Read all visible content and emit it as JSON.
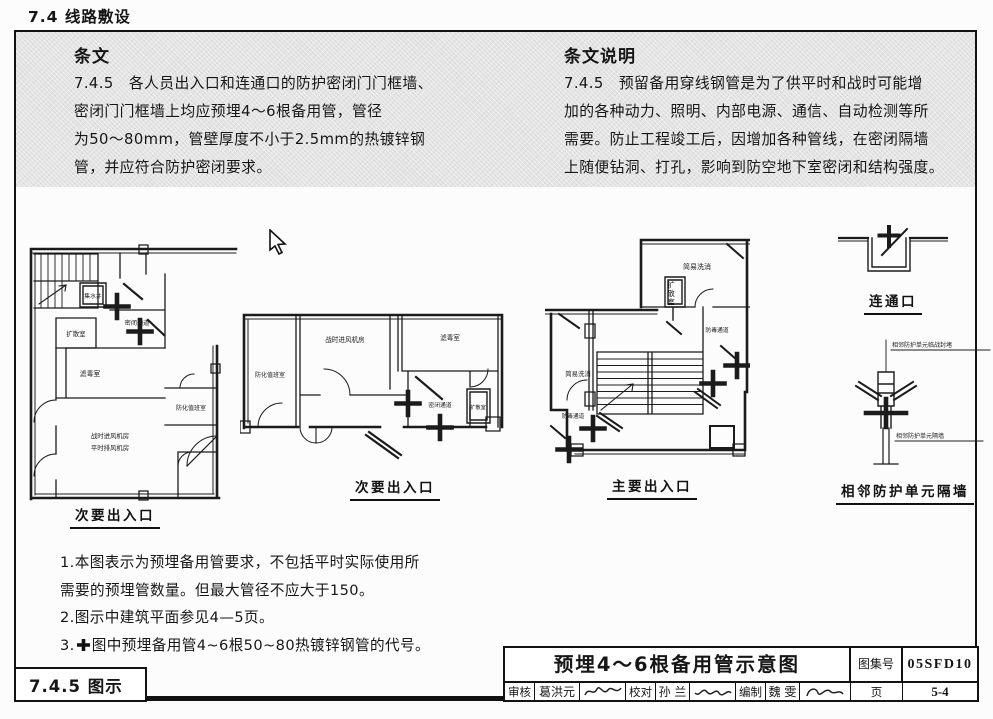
{
  "page": {
    "section_header": "7.4 线路敷设",
    "figure_label": "7.4.5 图示"
  },
  "clause": {
    "heading": "条文",
    "lines": [
      "7.4.5　各人员出入口和连通口的防护密闭门门框墙、",
      "密闭门门框墙上均应预埋4～6根备用管，管径",
      "为50～80mm，管壁厚度不小于2.5mm的热镀锌钢",
      "管，并应符合防护密闭要求。"
    ]
  },
  "explanation": {
    "heading": "条文说明",
    "lines": [
      "7.4.5　预留备用穿线钢管是为了供平时和战时可能增",
      "加的各种动力、照明、内部电源、通信、自动检测等所",
      "需要。防止工程竣工后，因增加各种管线，在密闭隔墙",
      "上随便钻洞、打孔，影响到防空地下室密闭和结构强度。"
    ]
  },
  "plans": {
    "plan1": {
      "caption": "次要出入口",
      "rooms": {
        "sump": "集水井",
        "diffusion": "扩散室",
        "sealed_passage": "密闭通道",
        "filter": "滤毒室",
        "duty": "防化值班室",
        "fan_line1": "战时进风机房",
        "fan_line2": "平时排风机房"
      }
    },
    "plan2": {
      "caption": "次要出入口",
      "rooms": {
        "duty": "防化值班室",
        "fan": "战时进风机房",
        "filter": "滤毒室",
        "sealed_passage": "密闭通道",
        "diffusion": "扩散室"
      }
    },
    "plan3": {
      "caption": "主要出入口",
      "rooms": {
        "wash_right": "简易洗消",
        "diffusion": "扩散室",
        "gas_passage_right": "防毒通道",
        "wash_left": "简易洗消",
        "gas_passage_left": "防毒通道"
      }
    },
    "detail_top": {
      "caption": "连通口"
    },
    "detail_bottom": {
      "caption": "相邻防护单元隔墙",
      "label_blocking": "相邻防护单元临战封堵",
      "label_wall": "相邻防护单元隔墙"
    }
  },
  "notes": {
    "lines": [
      "1.本图表示为预埋备用管要求，不包括平时实际使用所",
      "需要的预埋管数量。但最大管径不应大于150。",
      "2.图示中建筑平面参见4—5页。"
    ],
    "line4_prefix": "3.",
    "line4_symbol_icon": "heavy-plus-cross",
    "line4_text": "图中预埋备用管4~6根50~80热镀锌钢管的代号。"
  },
  "titleblock": {
    "title": "预埋4～6根备用管示意图",
    "atlas_label": "图集号",
    "atlas_number": "05SFD10",
    "page_label": "页",
    "page_number": "5-4",
    "review_label": "审核",
    "reviewer": "葛洪元",
    "proofread_label": "校对",
    "proofreader": "孙 兰",
    "compile_label": "编制",
    "compiler": "魏 雯"
  }
}
